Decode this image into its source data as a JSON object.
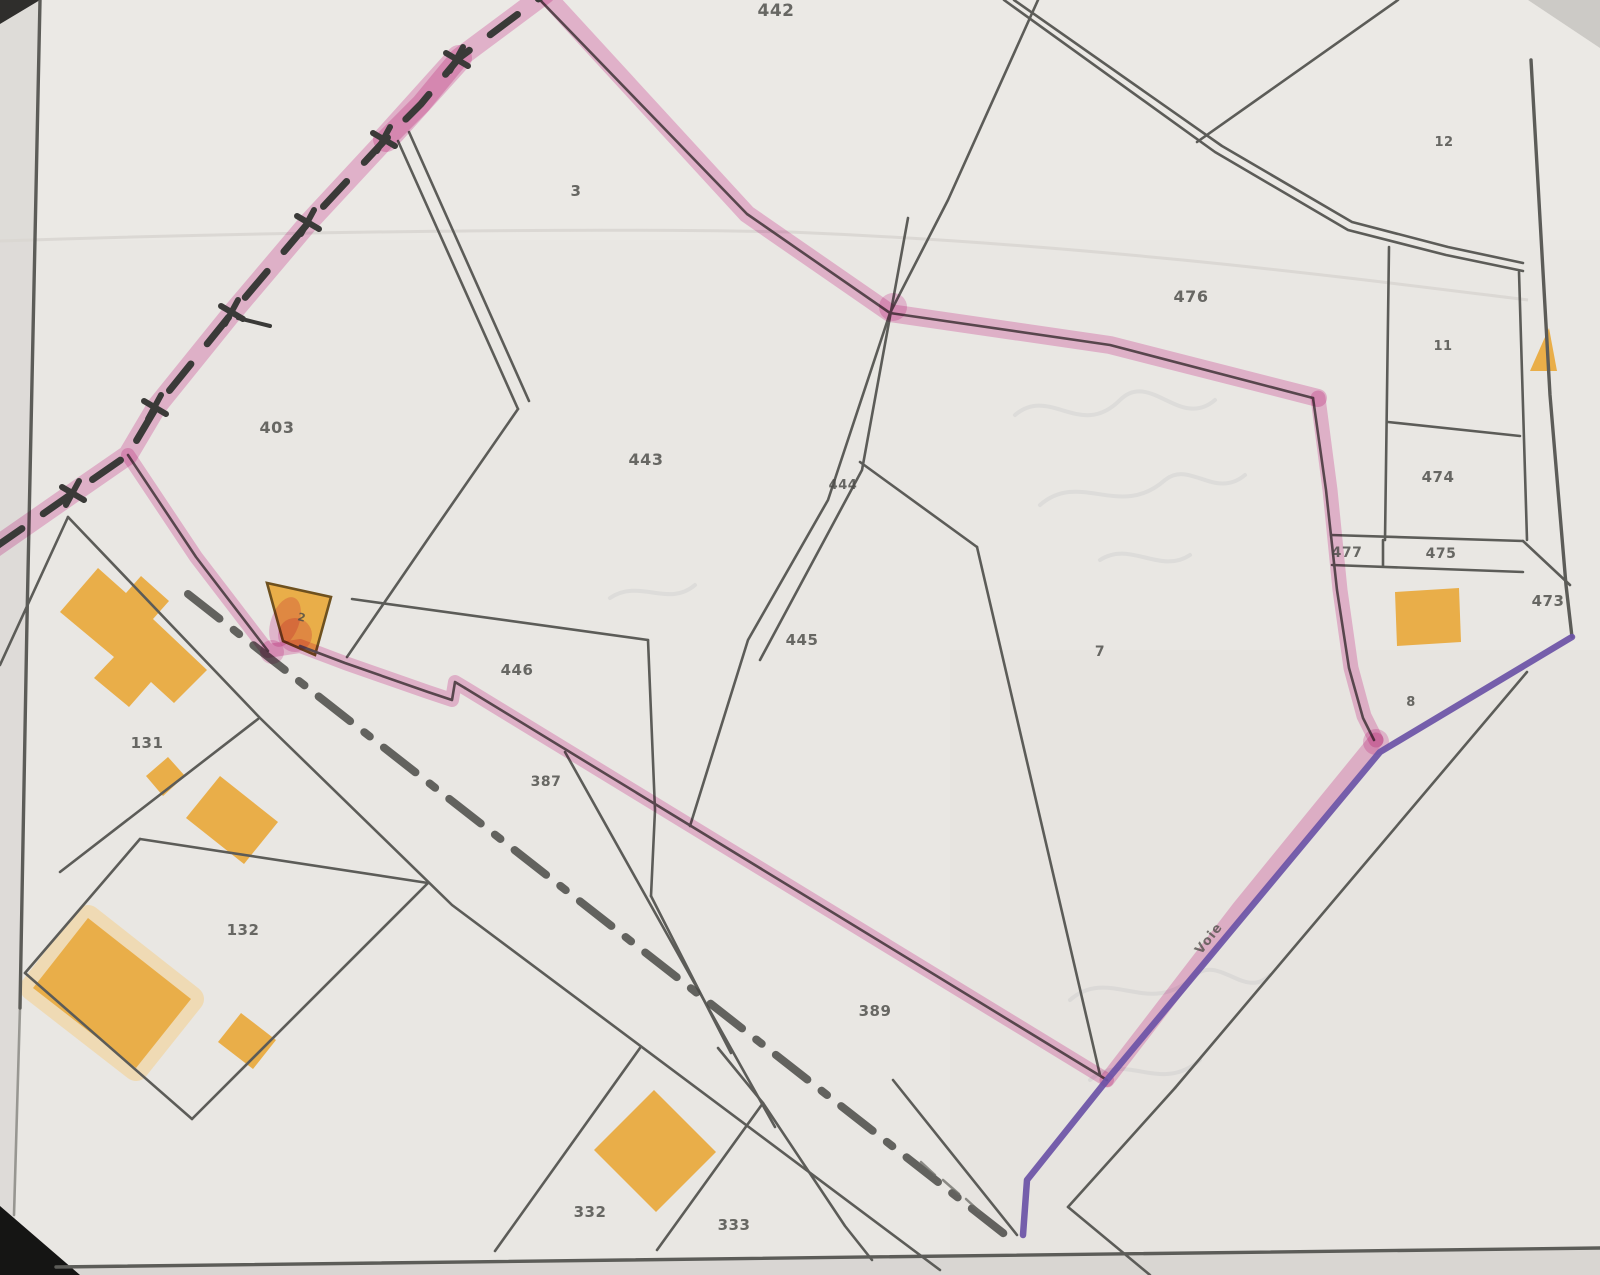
{
  "document": {
    "kind": "scanned cadastral plan (plan cadastral)",
    "orientation": "parcel map with highlighted boundary"
  },
  "labels": {
    "parcels": [
      {
        "text": "442",
        "x": 776,
        "y": 16,
        "size": 17
      },
      {
        "text": "3",
        "x": 576,
        "y": 196,
        "size": 15
      },
      {
        "text": "12",
        "x": 1444,
        "y": 146,
        "size": 13
      },
      {
        "text": "476",
        "x": 1191,
        "y": 302,
        "size": 16
      },
      {
        "text": "11",
        "x": 1443,
        "y": 350,
        "size": 13
      },
      {
        "text": "474",
        "x": 1438,
        "y": 482,
        "size": 15
      },
      {
        "text": "477",
        "x": 1347,
        "y": 557,
        "size": 14
      },
      {
        "text": "475",
        "x": 1441,
        "y": 558,
        "size": 14
      },
      {
        "text": "473",
        "x": 1548,
        "y": 606,
        "size": 15
      },
      {
        "text": "8",
        "x": 1411,
        "y": 706,
        "size": 13
      },
      {
        "text": "7",
        "x": 1100,
        "y": 656,
        "size": 14
      },
      {
        "text": "403",
        "x": 277,
        "y": 433,
        "size": 16
      },
      {
        "text": "443",
        "x": 646,
        "y": 465,
        "size": 16
      },
      {
        "text": "444",
        "x": 843,
        "y": 489,
        "size": 13
      },
      {
        "text": "445",
        "x": 802,
        "y": 645,
        "size": 15
      },
      {
        "text": "446",
        "x": 517,
        "y": 675,
        "size": 15
      },
      {
        "text": "387",
        "x": 546,
        "y": 786,
        "size": 14
      },
      {
        "text": "131",
        "x": 147,
        "y": 748,
        "size": 15
      },
      {
        "text": "132",
        "x": 243,
        "y": 935,
        "size": 15
      },
      {
        "text": "389",
        "x": 875,
        "y": 1016,
        "size": 15
      },
      {
        "text": "332",
        "x": 590,
        "y": 1217,
        "size": 15
      },
      {
        "text": "333",
        "x": 734,
        "y": 1230,
        "size": 15
      },
      {
        "text": "2",
        "x": 301,
        "y": 621,
        "size": 11,
        "rotation": 14
      }
    ],
    "road_name": {
      "text": "Voie",
      "x": 1212,
      "y": 941,
      "rotation": -52,
      "size": 13
    }
  },
  "colors": {
    "paper": "#e9e7e3",
    "line": "#5c5c58",
    "label": "#4b4b47",
    "pink_highlight": "#e785c2",
    "purple_line": "#6b52a6",
    "building_orange": "#e9ae49",
    "building_halo": "#f0d6a4",
    "dash_boundary": "#3a3a38"
  }
}
